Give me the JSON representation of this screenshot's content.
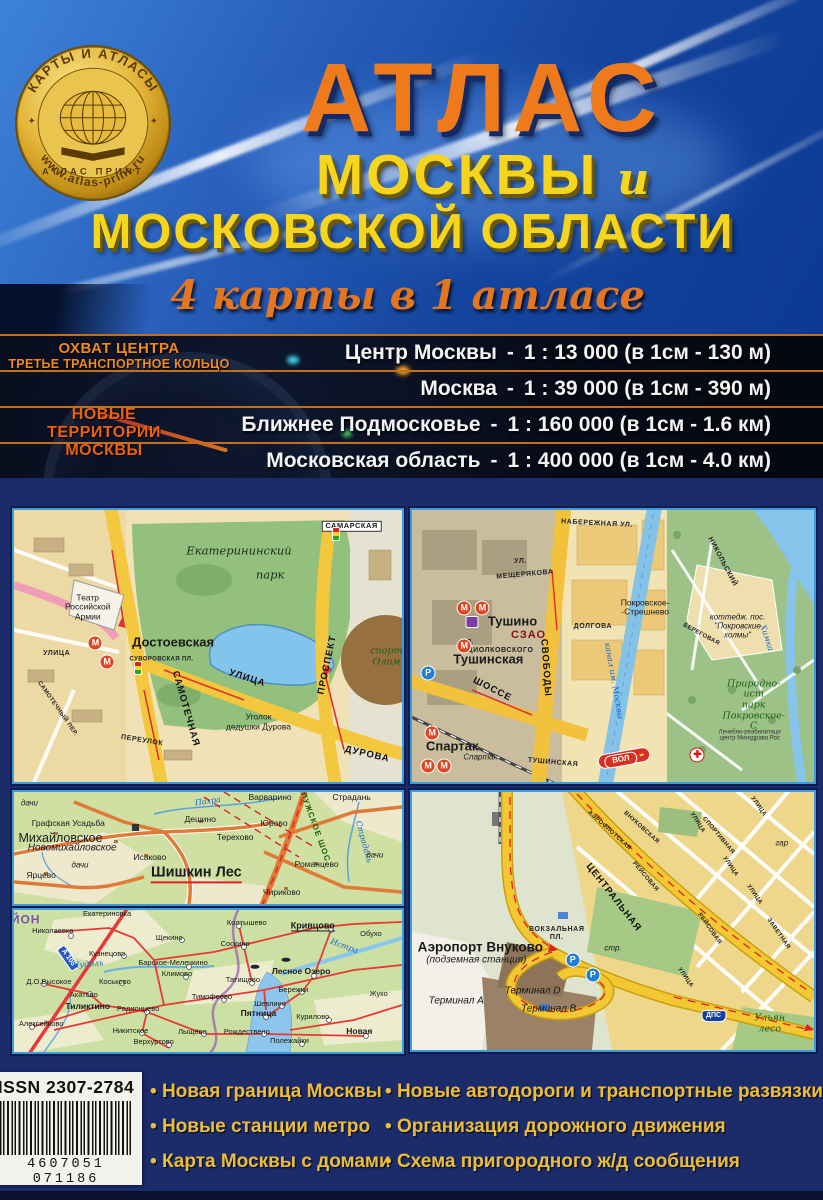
{
  "logo": {
    "top_text": "КАРТЫ И АТЛАСЫ",
    "bottom_text": "www.atlas-print.ru",
    "center_text": "АТЛАС ПРИНТ",
    "star": "✦"
  },
  "title": {
    "line1": "АТЛАС",
    "line2": "МОСКВЫ",
    "conj": "и",
    "line3": "МОСКОВСКОЙ ОБЛАСТИ",
    "subtitle": "4 карты в 1 атласе"
  },
  "scales": {
    "dash": "-",
    "left_top": [
      "ОХВАТ ЦЕНТРА",
      "ТРЕТЬЕ ТРАНСПОРТНОЕ КОЛЬЦО"
    ],
    "left_new": [
      "НОВЫЕ",
      "ТЕРРИТОРИИ",
      "МОСКВЫ"
    ],
    "rows": [
      {
        "name": "Центр Москвы",
        "scale": "1 : 13 000 (в 1см - 130 м)"
      },
      {
        "name": "Москва",
        "scale": "1 : 39 000 (в 1см - 390 м)"
      },
      {
        "name": "Ближнее Подмосковье",
        "scale": "1 : 160 000 (в 1см - 1.6 км)"
      },
      {
        "name": "Московская область",
        "scale": "1 : 400 000 (в 1см - 4.0 км)"
      }
    ]
  },
  "maps": {
    "dostoevskaya": {
      "labels": [
        {
          "t": "САМАРСКАЯ",
          "x": 87,
          "y": 6,
          "k": "street-badge"
        },
        {
          "t": "",
          "x": 83,
          "y": 9,
          "k": "traffic"
        },
        {
          "t": "Екатерининский",
          "x": 58,
          "y": 15,
          "k": "park"
        },
        {
          "t": "парк",
          "x": 66,
          "y": 24,
          "k": "park"
        },
        {
          "t": "Театр\nРоссийской\nАрмии",
          "x": 19,
          "y": 36,
          "k": "plain"
        },
        {
          "t": "М",
          "x": 21,
          "y": 49,
          "k": "metro"
        },
        {
          "t": "Достоевская",
          "x": 41,
          "y": 49,
          "k": "station"
        },
        {
          "t": "М",
          "x": 24,
          "y": 56,
          "k": "metro"
        },
        {
          "t": "УЛИЦА",
          "x": 11,
          "y": 53,
          "k": "street"
        },
        {
          "t": "СУВОРОВСКАЯ ПЛ.",
          "x": 38,
          "y": 55,
          "k": "street-sm"
        },
        {
          "t": "",
          "x": 32,
          "y": 58,
          "k": "traffic"
        },
        {
          "t": "спорт\nОлим",
          "x": 96,
          "y": 54,
          "k": "green"
        },
        {
          "t": "ПРОСПЕКТ",
          "x": 81,
          "y": 57,
          "k": "street-lg",
          "r": -78
        },
        {
          "t": "САМОТЕЧНАЯ",
          "x": 44,
          "y": 73,
          "k": "street-lg",
          "r": 74
        },
        {
          "t": "УЛИЦА",
          "x": 60,
          "y": 62,
          "k": "street-lg",
          "r": 18
        },
        {
          "t": "Уголок\nдедушки Дурова",
          "x": 63,
          "y": 78,
          "k": "plain"
        },
        {
          "t": "ПЕРЕУЛОК",
          "x": 33,
          "y": 85,
          "k": "street",
          "r": 9
        },
        {
          "t": "САМОТЕЧНЫЙ ПЕР.",
          "x": 11,
          "y": 73,
          "k": "street-sm",
          "r": 55
        },
        {
          "t": "ДУРОВА",
          "x": 91,
          "y": 90,
          "k": "street-lg",
          "r": 13
        }
      ]
    },
    "tushino": {
      "labels": [
        {
          "t": "НАБЕРЕЖНАЯ УЛ.",
          "x": 46,
          "y": 5,
          "k": "street",
          "r": 3
        },
        {
          "t": "УЛ.",
          "x": 27,
          "y": 19,
          "k": "street"
        },
        {
          "t": "МЕЩЕРЯКОВА",
          "x": 28,
          "y": 24,
          "k": "street",
          "r": -5
        },
        {
          "t": "НИКОЛЬСКИЙ",
          "x": 77,
          "y": 19,
          "k": "street",
          "r": 62
        },
        {
          "t": "",
          "x": 51,
          "y": 28,
          "k": "flag"
        },
        {
          "t": "Покровское-\n-Стрешнево",
          "x": 58,
          "y": 36,
          "k": "plain"
        },
        {
          "t": "СЗАО",
          "x": 29,
          "y": 46,
          "k": "district"
        },
        {
          "t": "ДОЛГОВА",
          "x": 45,
          "y": 43,
          "k": "street"
        },
        {
          "t": "СВОБОДЫ",
          "x": 33,
          "y": 58,
          "k": "street-lg",
          "r": 86
        },
        {
          "t": "ЦИОЛКОВСКОГО",
          "x": 22,
          "y": 52,
          "k": "street"
        },
        {
          "t": "УЛ.",
          "x": 14,
          "y": 49,
          "k": "street-sm"
        },
        {
          "t": "М",
          "x": 13,
          "y": 36,
          "k": "metro"
        },
        {
          "t": "М",
          "x": 17.5,
          "y": 36,
          "k": "metro"
        },
        {
          "t": "",
          "x": 15,
          "y": 41,
          "k": "train"
        },
        {
          "t": "Тушино",
          "x": 25,
          "y": 41,
          "k": "station"
        },
        {
          "t": "М",
          "x": 13,
          "y": 50,
          "k": "metro"
        },
        {
          "t": "Тушинская",
          "x": 19,
          "y": 55,
          "k": "station"
        },
        {
          "t": "P",
          "x": 4,
          "y": 60,
          "k": "parking"
        },
        {
          "t": "ШОССЕ",
          "x": 20,
          "y": 66,
          "k": "street-lg",
          "r": 27
        },
        {
          "t": "ТУШИНСКАЯ",
          "x": 35,
          "y": 93,
          "k": "street",
          "r": 5
        },
        {
          "t": "М",
          "x": 5,
          "y": 82,
          "k": "metro"
        },
        {
          "t": "Спартак",
          "x": 10,
          "y": 87,
          "k": "station"
        },
        {
          "t": "Спартак",
          "x": 17,
          "y": 91,
          "k": "italic-sm"
        },
        {
          "t": "М",
          "x": 4,
          "y": 94,
          "k": "metro"
        },
        {
          "t": "М",
          "x": 8,
          "y": 94,
          "k": "metro"
        },
        {
          "t": "канал им. Москвы",
          "x": 50,
          "y": 63,
          "k": "water",
          "r": 80
        },
        {
          "t": "ВОЛ",
          "x": 52,
          "y": 92,
          "k": "road-red",
          "r": -10
        },
        {
          "t": "Природно-ист\nпарк\nПокровское-С",
          "x": 85,
          "y": 72,
          "k": "green"
        },
        {
          "t": "Лечебно-реабилитаци\nцентр Минздрава Рос",
          "x": 84,
          "y": 83,
          "k": "tiny"
        },
        {
          "t": "✚",
          "x": 71,
          "y": 90,
          "k": "redcross"
        },
        {
          "t": "коттедж. пос.\n\"Покровские\nхолмы\"",
          "x": 81,
          "y": 43,
          "k": "italic-sm"
        },
        {
          "t": "Химка",
          "x": 88,
          "y": 47,
          "k": "water",
          "r": 72
        },
        {
          "t": "БЕРЕГОВАЯ",
          "x": 72,
          "y": 46,
          "k": "street-sm",
          "r": 28
        }
      ]
    },
    "shishkin_les": {
      "labels": [
        {
          "t": "дачи",
          "x": 4,
          "y": 11,
          "k": "italic-sm"
        },
        {
          "t": "Графская Усадьба",
          "x": 14,
          "y": 29,
          "k": "plain"
        },
        {
          "t": "Михайловское",
          "x": 12,
          "y": 41,
          "k": "village-lg"
        },
        {
          "t": "Новомихайловское",
          "x": 15,
          "y": 50,
          "k": "italic"
        },
        {
          "t": "Исаково",
          "x": 35,
          "y": 59,
          "k": "plain"
        },
        {
          "t": "дачи",
          "x": 17,
          "y": 66,
          "k": "italic-sm"
        },
        {
          "t": "Ярцево",
          "x": 7,
          "y": 75,
          "k": "plain"
        },
        {
          "t": "Шишкин Лес",
          "x": 47,
          "y": 73,
          "k": "town-underline"
        },
        {
          "t": "Дешино",
          "x": 48,
          "y": 25,
          "k": "plain"
        },
        {
          "t": "Пахра",
          "x": 50,
          "y": 9,
          "k": "water",
          "r": -8
        },
        {
          "t": "Варварино",
          "x": 66,
          "y": 5,
          "k": "plain"
        },
        {
          "t": "Страдань",
          "x": 87,
          "y": 5,
          "k": "plain"
        },
        {
          "t": "Юрово",
          "x": 67,
          "y": 29,
          "k": "plain"
        },
        {
          "t": "Терехово",
          "x": 57,
          "y": 41,
          "k": "plain"
        },
        {
          "t": "КАЛУЖСКОЕ ШОС.",
          "x": 77,
          "y": 28,
          "k": "road-green",
          "r": 70
        },
        {
          "t": "Романцево",
          "x": 78,
          "y": 65,
          "k": "plain"
        },
        {
          "t": "Чириково",
          "x": 69,
          "y": 90,
          "k": "plain"
        },
        {
          "t": "Страдань",
          "x": 90,
          "y": 45,
          "k": "water",
          "r": 75
        },
        {
          "t": "дачи",
          "x": 93,
          "y": 57,
          "k": "italic-sm"
        }
      ]
    },
    "oblast": {
      "labels": [
        {
          "t": "ЙОН",
          "x": 3,
          "y": 7,
          "k": "district-purple"
        },
        {
          "t": "Николаевка",
          "x": 10,
          "y": 15,
          "k": "plain-sm"
        },
        {
          "t": "Екатериновка",
          "x": 24,
          "y": 3,
          "k": "plain-sm"
        },
        {
          "t": "Щекино",
          "x": 40,
          "y": 20,
          "k": "plain-sm"
        },
        {
          "t": "Колтышево",
          "x": 60,
          "y": 9,
          "k": "plain-sm"
        },
        {
          "t": "Кривцово",
          "x": 77,
          "y": 11,
          "k": "bold-underline-sm"
        },
        {
          "t": "Обухо",
          "x": 92,
          "y": 17,
          "k": "plain-sm"
        },
        {
          "t": "Соскино",
          "x": 57,
          "y": 24,
          "k": "plain-sm"
        },
        {
          "t": "Кузнецово",
          "x": 24,
          "y": 31,
          "k": "plain-sm"
        },
        {
          "t": "А 108",
          "x": 14,
          "y": 34,
          "k": "roadnum",
          "r": 55
        },
        {
          "t": "Нудоль",
          "x": 19,
          "y": 39,
          "k": "water",
          "r": -5
        },
        {
          "t": "Барское-Мелечкино",
          "x": 41,
          "y": 37,
          "k": "plain-sm"
        },
        {
          "t": "Климово",
          "x": 42,
          "y": 45,
          "k": "plain-sm"
        },
        {
          "t": "Татищево",
          "x": 59,
          "y": 49,
          "k": "plain-sm"
        },
        {
          "t": "Лесное Озеро",
          "x": 74,
          "y": 44,
          "k": "bold-sm"
        },
        {
          "t": "Истра",
          "x": 85,
          "y": 26,
          "k": "water",
          "r": 20
        },
        {
          "t": "Д.О.Высокое",
          "x": 9,
          "y": 51,
          "k": "plain-sm"
        },
        {
          "t": "Коськово",
          "x": 26,
          "y": 51,
          "k": "plain-sm"
        },
        {
          "t": "Акатово",
          "x": 18,
          "y": 60,
          "k": "plain-sm"
        },
        {
          "t": "Тиликтино",
          "x": 19,
          "y": 68,
          "k": "bold-sm"
        },
        {
          "t": "Радионцево",
          "x": 32,
          "y": 70,
          "k": "plain-sm"
        },
        {
          "t": "Тимофеево",
          "x": 51,
          "y": 61,
          "k": "plain-sm"
        },
        {
          "t": "Шевлино",
          "x": 66,
          "y": 66,
          "k": "plain-sm"
        },
        {
          "t": "Бережки",
          "x": 72,
          "y": 56,
          "k": "plain-sm"
        },
        {
          "t": "Жуко",
          "x": 94,
          "y": 59,
          "k": "plain-sm"
        },
        {
          "t": "Пятница",
          "x": 63,
          "y": 73,
          "k": "bold-sm"
        },
        {
          "t": "Курилово",
          "x": 77,
          "y": 75,
          "k": "plain-sm"
        },
        {
          "t": "Алексейково",
          "x": 7,
          "y": 80,
          "k": "plain-sm"
        },
        {
          "t": "Никитское",
          "x": 30,
          "y": 85,
          "k": "plain-sm"
        },
        {
          "t": "Лыщёво",
          "x": 46,
          "y": 86,
          "k": "plain-sm"
        },
        {
          "t": "Рождествено",
          "x": 60,
          "y": 86,
          "k": "plain-sm"
        },
        {
          "t": "Новая",
          "x": 89,
          "y": 86,
          "k": "bold-sm"
        },
        {
          "t": "Полежайки",
          "x": 71,
          "y": 92,
          "k": "plain-sm"
        },
        {
          "t": "Верхуртово",
          "x": 36,
          "y": 93,
          "k": "plain-sm"
        },
        {
          "t": "",
          "x": 62,
          "y": 40,
          "k": "fish"
        },
        {
          "t": "",
          "x": 70,
          "y": 35,
          "k": "fish"
        }
      ]
    },
    "vnukovo": {
      "labels": [
        {
          "t": "ЦЕНТРАЛЬНАЯ",
          "x": 50,
          "y": 41,
          "k": "street-lg",
          "r": 52
        },
        {
          "t": "АЭРОФЛОТСКАЯ",
          "x": 49,
          "y": 15,
          "k": "street-sm",
          "r": 42
        },
        {
          "t": "ВНУКОВСКАЯ",
          "x": 57,
          "y": 14,
          "k": "street-sm",
          "r": 42
        },
        {
          "t": "РЕЙСОВАЯ",
          "x": 58,
          "y": 33,
          "k": "street-sm",
          "r": 50
        },
        {
          "t": "СПОРТИВНАЯ",
          "x": 76,
          "y": 17,
          "k": "street-sm",
          "r": 50
        },
        {
          "t": "УЛИЦА",
          "x": 71,
          "y": 12,
          "k": "street-sm",
          "r": 58
        },
        {
          "t": "УЛИЦА",
          "x": 79,
          "y": 29,
          "k": "street-sm",
          "r": 55
        },
        {
          "t": "УЛИЦА",
          "x": 86,
          "y": 6,
          "k": "street-sm",
          "r": 55
        },
        {
          "t": "УЛИЦА",
          "x": 85,
          "y": 40,
          "k": "street-sm",
          "r": 55
        },
        {
          "t": "гар",
          "x": 92,
          "y": 20,
          "k": "italic-sm"
        },
        {
          "t": "РЕЙСОВАЯ",
          "x": 74,
          "y": 53,
          "k": "street-sm",
          "r": 55
        },
        {
          "t": "ЗАВЕТНАЯ",
          "x": 91,
          "y": 55,
          "k": "street-sm",
          "r": 55
        },
        {
          "t": "ВОКЗАЛЬНАЯ\nПЛ.",
          "x": 36,
          "y": 55,
          "k": "street"
        },
        {
          "t": "стр.",
          "x": 50,
          "y": 61,
          "k": "italic-sm"
        },
        {
          "t": "Аэропорт Внуково",
          "x": 17,
          "y": 60,
          "k": "town"
        },
        {
          "t": "(подземная станция)",
          "x": 16,
          "y": 65,
          "k": "italic"
        },
        {
          "t": "Терминал А",
          "x": 11,
          "y": 81,
          "k": "italic"
        },
        {
          "t": "Терминал D",
          "x": 30,
          "y": 77,
          "k": "italic"
        },
        {
          "t": "Терминал В",
          "x": 34,
          "y": 84,
          "k": "italic"
        },
        {
          "t": "P",
          "x": 40,
          "y": 65,
          "k": "parking"
        },
        {
          "t": "P",
          "x": 45,
          "y": 71,
          "k": "parking"
        },
        {
          "t": "ДПС",
          "x": 75,
          "y": 87,
          "k": "dps"
        },
        {
          "t": "УЛИЦА",
          "x": 68,
          "y": 72,
          "k": "street-sm",
          "r": 55
        },
        {
          "t": "Ульян\nлесо",
          "x": 89,
          "y": 90,
          "k": "green"
        }
      ]
    }
  },
  "footer": {
    "issn": "ISSN 2307-2784",
    "barcode_digits": "4607051 071186",
    "bullets_left": [
      "Новая граница Москвы",
      "Новые станции метро",
      "Карта Москвы с домами"
    ],
    "bullets_right": [
      "Новые автодороги и транспортные развязки",
      "Организация дорожного движения",
      "Схема пригородного ж/д сообщения"
    ]
  },
  "colors": {
    "accent_orange": "#ee7a1c",
    "accent_yellow": "#f6d51f",
    "cover_blue": "#1c2c6a",
    "panel_border": "#3f9ad8",
    "bullet_yellow": "#eebd35",
    "separator_orange": "#c2701c"
  }
}
